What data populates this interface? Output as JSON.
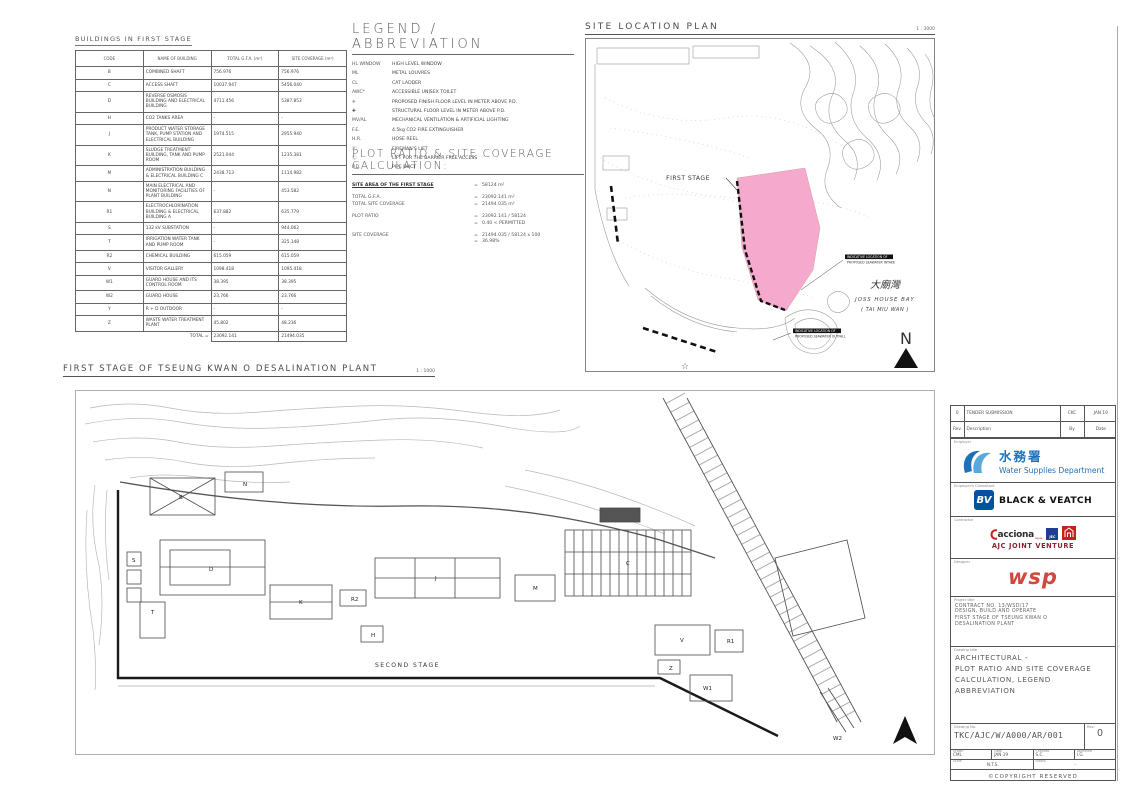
{
  "colors": {
    "pink": "#f5a9cc",
    "wsd_blue": "#1d71b8",
    "wsd_blue_light": "#5aa7dc",
    "bv_blue": "#00529c",
    "jec_blue": "#1d3e92",
    "cscec_red": "#c8201d",
    "ajc_text": "#8b2332",
    "wsp_red": "#d0493f"
  },
  "buildings_table": {
    "title": "BUILDINGS IN FIRST STAGE",
    "columns": [
      "CODE",
      "NAME OF BUILDING",
      "TOTAL G.F.A. (m²)",
      "SITE COVERAGE (m²)"
    ],
    "rows": [
      {
        "code": "B",
        "name": "COMBINED SHAFT",
        "gfa": "756.976",
        "cov": "756.976"
      },
      {
        "code": "C",
        "name": "ACCESS SHAFT",
        "gfa": "10037.947",
        "cov": "5456.040"
      },
      {
        "code": "D",
        "name": "REVERSE OSMOSIS BUILDING AND ELECTRICAL BUILDING",
        "gfa": "4711.456",
        "cov": "5387.853"
      },
      {
        "code": "H",
        "name": "CO2 TANKS AREA",
        "gfa": "-",
        "cov": "-"
      },
      {
        "code": "J",
        "name": "PRODUCT WATER STORAGE TANK, PUMP STATION AND ELECTRICAL BUILDING",
        "gfa": "1974.515",
        "cov": "2955.940"
      },
      {
        "code": "K",
        "name": "SLUDGE TREATMENT BUILDING, TANK AND PUMP ROOM",
        "gfa": "2521.044",
        "cov": "1235.381"
      },
      {
        "code": "M",
        "name": "ADMINISTRATION BUILDING & ELECTRICAL BUILDING C",
        "gfa": "2438.713",
        "cov": "1114.982"
      },
      {
        "code": "N",
        "name": "MAIN ELECTRICAL AND MONITORING FACILITIES OF PLANT BUILDING",
        "gfa": "-",
        "cov": "453.582"
      },
      {
        "code": "R1",
        "name": "ELECTROCHLORINATION BUILDING & ELECTRICAL BUILDING A",
        "gfa": "637.882",
        "cov": "635.779"
      },
      {
        "code": "S",
        "name": "132 kV SUBSTATION",
        "gfa": "-",
        "cov": "944.062"
      },
      {
        "code": "T",
        "name": "IRRIGATION WATER TANK AND PUMP ROOM",
        "gfa": "-",
        "cov": "325.148"
      },
      {
        "code": "R2",
        "name": "CHEMICAL BUILDING",
        "gfa": "615.059",
        "cov": "615.059"
      },
      {
        "code": "V",
        "name": "VISITOR GALLERY",
        "gfa": "1098.418",
        "cov": "1095.418"
      },
      {
        "code": "W1",
        "name": "GUARD HOUSE AND ITS CONTROL ROOM",
        "gfa": "38.395",
        "cov": "38.395"
      },
      {
        "code": "W2",
        "name": "GUARD HOUSE",
        "gfa": "23.766",
        "cov": "23.766"
      },
      {
        "code": "Y",
        "name": "R + D OUTDOOR",
        "gfa": "-",
        "cov": "-"
      },
      {
        "code": "Z",
        "name": "WASTE WATER TREATMENT PLANT",
        "gfa": "45.802",
        "cov": "48.236"
      }
    ],
    "total": {
      "label": "TOTAL =",
      "gfa": "23092.141",
      "cov": "21494.035"
    }
  },
  "legend": {
    "title": "LEGEND / ABBREVIATION",
    "items": [
      {
        "code": "HL WINDOW",
        "desc": "HIGH LEVEL WINDOW"
      },
      {
        "code": "ML",
        "desc": "METAL LOUVRES"
      },
      {
        "code": "CL",
        "desc": "CAT LADDER"
      },
      {
        "code": "AWC*",
        "desc": "ACCESSIBLE UNISEX TOILET"
      },
      {
        "code": "✳",
        "desc": "PROPOSED FINISH FLOOR LEVEL IN METER ABOVE P.D."
      },
      {
        "code": "✚",
        "desc": "STRUCTURAL FLOOR LEVEL IN METER ABOVE P.D."
      },
      {
        "code": "MV/AL",
        "desc": "MECHANICAL VENTILATION & ARTIFICIAL LIGHTING"
      },
      {
        "code": "F.E.",
        "desc": "4.5kg CO2 FIRE EXTINGUISHER"
      },
      {
        "code": "H.R.",
        "desc": "HOSE REEL"
      },
      {
        "code": "Ⓕ",
        "desc": "FIREMAN'S LIFT"
      },
      {
        "code": "Ⓛ",
        "desc": "LIFT FOR THE BARRIER FREE ACCESS"
      },
      {
        "code": "P.D.",
        "desc": "PIPE DUCT"
      }
    ]
  },
  "plot_ratio": {
    "title": "PLOT RATIO & SITE COVERAGE CALCULATION:",
    "items": [
      {
        "label": "SITE AREA OF THE FIRST STAGE",
        "eq": "=",
        "value": "58124 m²",
        "strong": true
      },
      {
        "label": "TOTAL G.F.A.",
        "eq": "=",
        "value": "23092.141 m²",
        "gap": true
      },
      {
        "label": "TOTAL SITE COVERAGE",
        "eq": "=",
        "value": "21494.035 m²"
      },
      {
        "label": "PLOT RATIO",
        "eq": "=",
        "value": "23092.141 / 58124",
        "gap": true
      },
      {
        "label": "",
        "eq": "=",
        "value": "0.40   < PERMITTED"
      },
      {
        "label": "SITE COVERAGE",
        "eq": "=",
        "value": "21494.035 / 58124 x 100",
        "gap": true
      },
      {
        "label": "",
        "eq": "=",
        "value": "36.98%"
      }
    ]
  },
  "site_plan": {
    "title": "SITE LOCATION PLAN",
    "scale": "1 : 3000",
    "first_stage_label": "FIRST STAGE",
    "bay_name_cn": "大廟灣",
    "bay_name_en": "JOSS HOUSE BAY",
    "bay_name_en2": "( TAI MIU WAN )",
    "note1": [
      "INDICATIVE LOCATION OF",
      "PROPOSED SEAWATER INTAKE"
    ],
    "note2": [
      "INDICATIVE LOCATION OF",
      "PROPOSED SEAWATER OUTFALL"
    ],
    "north_label": "N",
    "star": "☆"
  },
  "main_plan": {
    "title": "FIRST STAGE OF TSEUNG KWAN O DESALINATION PLANT",
    "scale": "1 : 1000",
    "second_stage_label": "SECOND STAGE",
    "labels": [
      {
        "code": "N",
        "x": 168,
        "y": 96
      },
      {
        "code": "B",
        "x": 104,
        "y": 109
      },
      {
        "code": "D",
        "x": 134,
        "y": 181
      },
      {
        "code": "S",
        "x": 57,
        "y": 172
      },
      {
        "code": "T",
        "x": 76,
        "y": 224
      },
      {
        "code": "K",
        "x": 224,
        "y": 214
      },
      {
        "code": "R2",
        "x": 276,
        "y": 211
      },
      {
        "code": "H",
        "x": 296,
        "y": 247
      },
      {
        "code": "J",
        "x": 360,
        "y": 190
      },
      {
        "code": "M",
        "x": 458,
        "y": 200
      },
      {
        "code": "C",
        "x": 551,
        "y": 175
      },
      {
        "code": "V",
        "x": 605,
        "y": 252
      },
      {
        "code": "R1",
        "x": 652,
        "y": 253
      },
      {
        "code": "Z",
        "x": 594,
        "y": 280
      },
      {
        "code": "W1",
        "x": 628,
        "y": 300
      },
      {
        "code": "W2",
        "x": 758,
        "y": 350
      }
    ]
  },
  "title_block": {
    "revision": {
      "rev": "0",
      "description": "TENDER SUBMISSION",
      "by": "CKC",
      "date": "JAN 19",
      "headers": {
        "rev": "Rev.",
        "description": "Description",
        "by": "By",
        "date": "Date"
      }
    },
    "employer": {
      "label": "Employer",
      "name_cn": "水務署",
      "name_en": "Water Supplies Department"
    },
    "consultant": {
      "label": "Employer's Consultant",
      "logo_text": "BV",
      "name": "BLACK & VEATCH"
    },
    "contractor": {
      "label": "Contractor",
      "acciona": "acciona",
      "acciona_sub": "agua",
      "jec": "JEC",
      "name": "AJC JOINT VENTURE"
    },
    "designer": {
      "label": "Designer",
      "name": "wsp"
    },
    "project": {
      "label": "Project title",
      "contract": "CONTRACT NO. 13/WSD/17",
      "lines": [
        "DESIGN, BUILD AND OPERATE",
        "FIRST STAGE OF TSEUNG KWAN O",
        "DESALINATION PLANT"
      ]
    },
    "drawing": {
      "label": "Drawing title",
      "lines": [
        "ARCHITECTURAL -",
        "PLOT RATIO AND SITE COVERAGE",
        "CALCULATION, LEGEND",
        "ABBREVIATION"
      ]
    },
    "number": {
      "label": "Drawing No.",
      "value": "TKC/AJC/W/A000/AR/001",
      "rev_label": "Rev.",
      "rev": "0"
    },
    "meta": {
      "drawn_label": "Drawn",
      "drawn": "CML",
      "date_label": "Date",
      "date": "JAN 19",
      "checked_label": "Checked",
      "checked": "S.C.",
      "approved_label": "Approved",
      "approved": "I.G.",
      "scale_label": "Scale",
      "scale": "N.T.S.",
      "status_label": "Status",
      "status": "-"
    },
    "copyright": "©COPYRIGHT RESERVED"
  }
}
